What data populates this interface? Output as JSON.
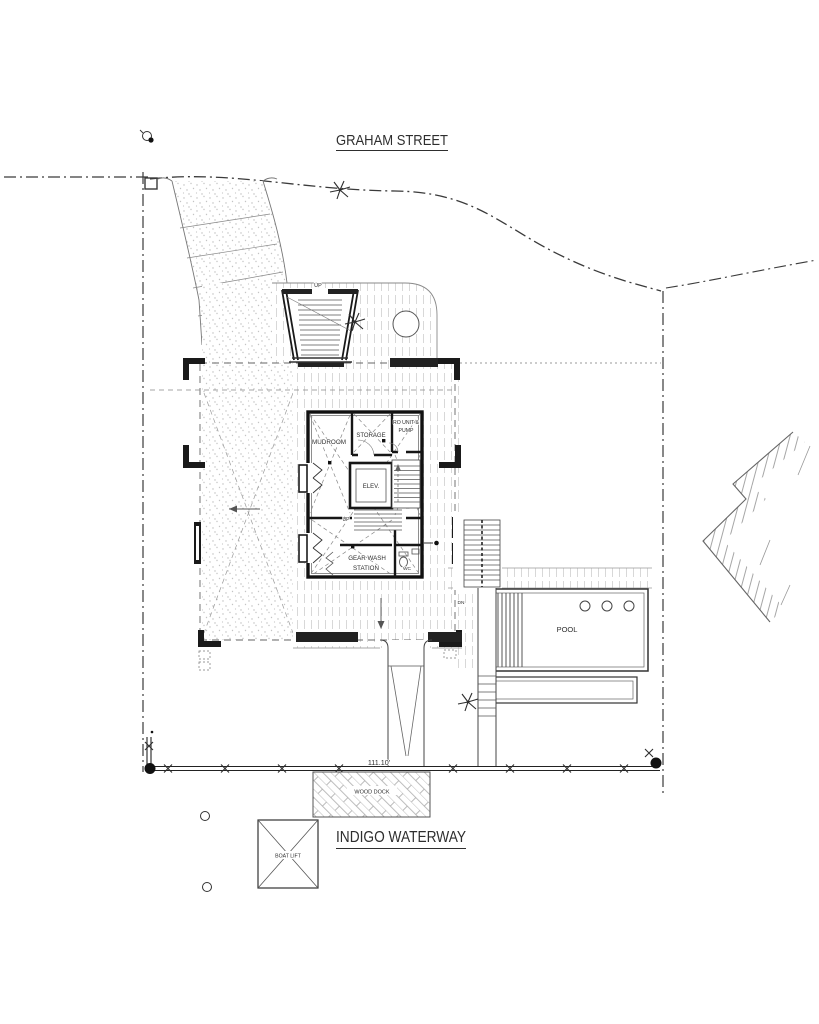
{
  "titles": {
    "street": "GRAHAM STREET",
    "waterway": "INDIGO WATERWAY"
  },
  "building": {
    "mudroom": "MUDROOM",
    "storage": "STORAGE",
    "ro_unit_line1": "RO UNIT &",
    "ro_unit_line2": "PUMP",
    "elevator": "ELEV.",
    "gear_wash_line1": "GEAR WASH",
    "gear_wash_line2": "STATION",
    "wc": "WC",
    "up_interior": "UP"
  },
  "site": {
    "entry_stair_up": "UP",
    "exterior_stair_dn": "DN",
    "pool": "POOL",
    "wood_dock": "WOOD DOCK",
    "boat_lift": "BOAT LIFT",
    "seawall_dimension": "111.10'"
  },
  "colors": {
    "ink": "#2e2e2e",
    "wall": "#161616",
    "hatch": "#c9c9c9",
    "stipple": "#bdbdbd"
  }
}
